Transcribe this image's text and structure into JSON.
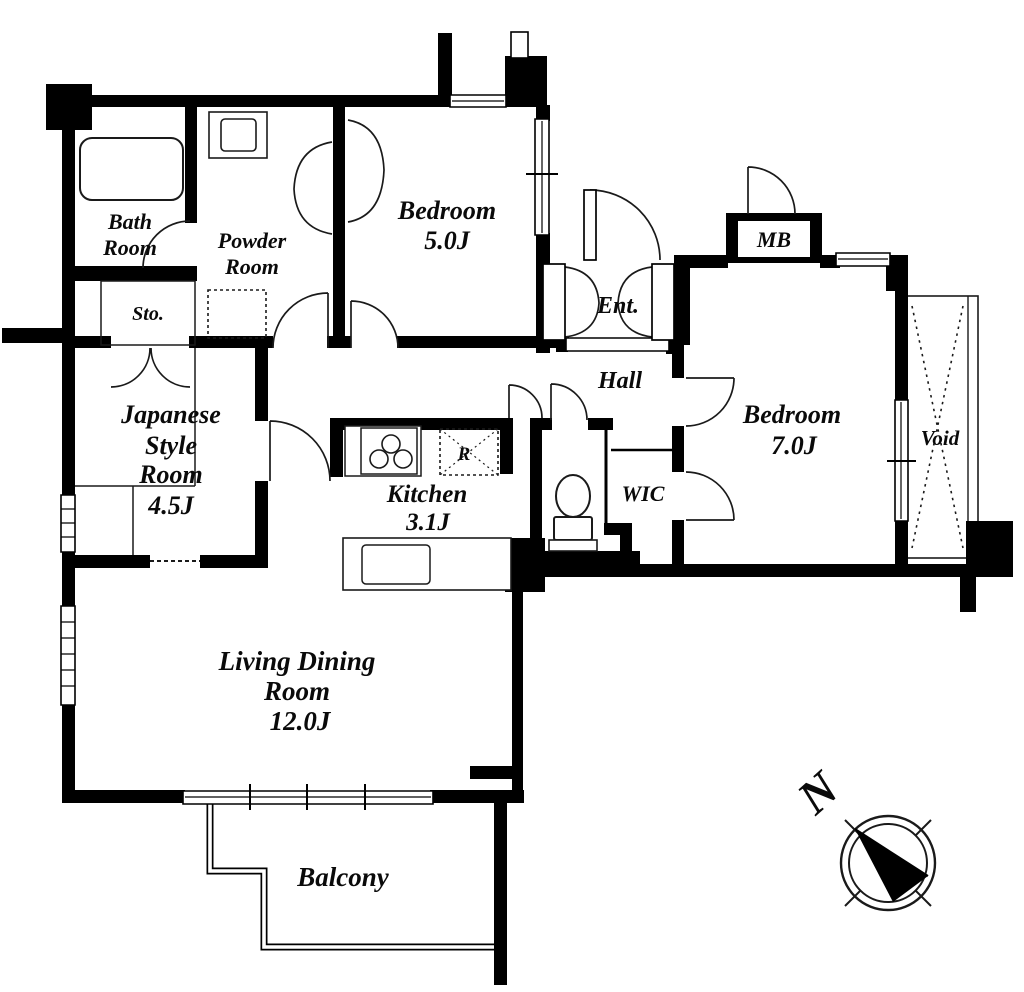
{
  "colors": {
    "wall": "#000000",
    "background": "#ffffff",
    "line": "#1a1a1a"
  },
  "labels": {
    "bath": [
      "Bath",
      "Room"
    ],
    "powder": [
      "Powder",
      "Room"
    ],
    "storage": "Sto.",
    "bedroom5": [
      "Bedroom",
      "5.0J"
    ],
    "entrance": "Ent.",
    "meter_box": "MB",
    "hall": "Hall",
    "bedroom7": [
      "Bedroom",
      "7.0J"
    ],
    "void": "Void",
    "japanese_room": [
      "Japanese",
      "Style",
      "Room",
      "4.5J"
    ],
    "kitchen": [
      "Kitchen",
      "3.1J"
    ],
    "refrigerator": "R",
    "wic": "WIC",
    "living_dining": [
      "Living Dining",
      "Room",
      "12.0J"
    ],
    "balcony": "Balcony",
    "compass_north": "N"
  }
}
